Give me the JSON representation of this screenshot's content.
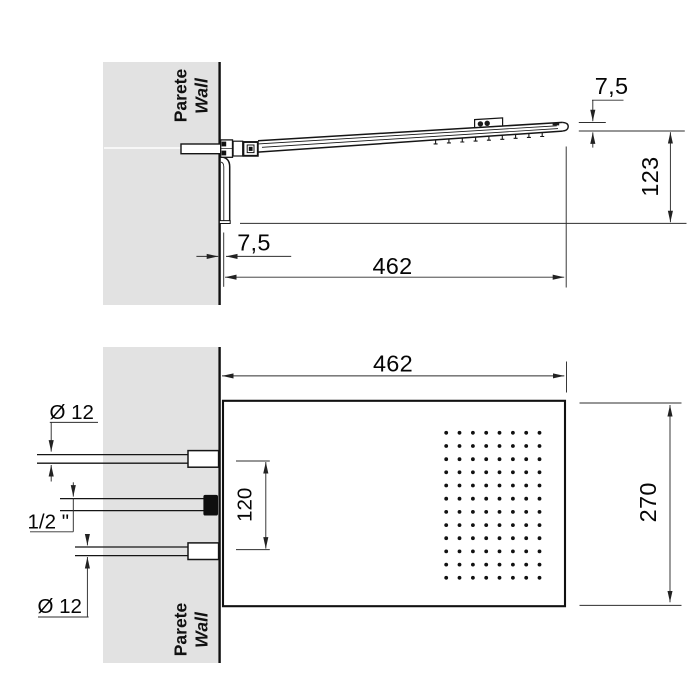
{
  "colors": {
    "wall_fill": "#e2e2e2",
    "line": "#151515",
    "dim_line": "#2e2e2e"
  },
  "side_view": {
    "wall_label": {
      "line1": "Parete",
      "line2": "Wall"
    },
    "dimensions": {
      "head_thickness": "7,5",
      "drop_height": "123",
      "wall_gap": "7,5",
      "length": "462"
    }
  },
  "front_view": {
    "wall_label": {
      "line1": "Parete",
      "line2": "Wall"
    },
    "dimensions": {
      "length": "462",
      "width": "270",
      "inlet_spacing": "120",
      "top_inlet_diameter": "Ø 12",
      "bottom_inlet_diameter": "Ø 12",
      "water_connection": "1/2 \""
    },
    "nozzle_grid": {
      "columns": 8,
      "rows": 12
    }
  }
}
